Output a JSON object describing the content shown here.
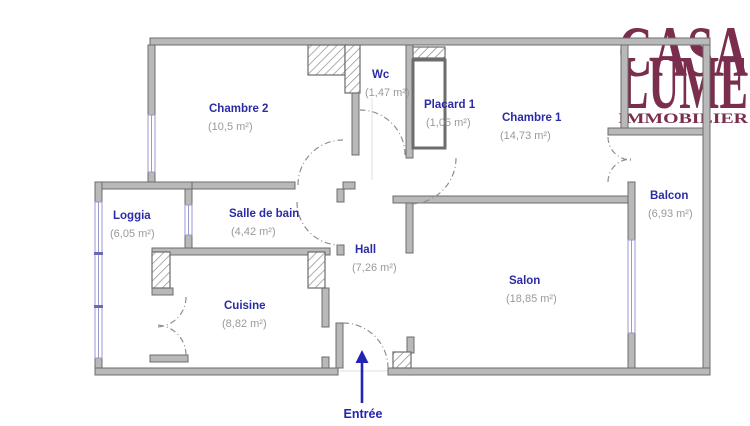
{
  "logo": {
    "title_line1": "CASA",
    "title_line2": "LUME",
    "subtitle": "IMMOBILIER",
    "color": "#7b2d4d"
  },
  "colors": {
    "room_name_blue": "#2b2ba6",
    "room_area_gray": "#9a9a9a",
    "wall_fill": "#b9b9b9",
    "wall_stroke": "#6c6c6c",
    "window_blue": "#9a9ad0",
    "door_arc_gray": "#8f8f8f",
    "entrance_arrow_blue": "#2323b4",
    "logo_maroon": "#7b2d4d"
  },
  "rooms": {
    "chambre2": {
      "name": "Chambre 2",
      "area": "(10,5 m²)"
    },
    "wc": {
      "name": "Wc",
      "area": "(1,47 m²)"
    },
    "placard1": {
      "name": "Placard 1",
      "area": "(1,05 m²)"
    },
    "chambre1": {
      "name": "Chambre 1",
      "area": "(14,73 m²)"
    },
    "balcon": {
      "name": "Balcon",
      "area": "(6,93 m²)"
    },
    "loggia": {
      "name": "Loggia",
      "area": "(6,05 m²)"
    },
    "salle_de_bain": {
      "name": "Salle de bain",
      "area": "(4,42 m²)"
    },
    "hall": {
      "name": "Hall",
      "area": "(7,26 m²)"
    },
    "cuisine": {
      "name": "Cuisine",
      "area": "(8,82 m²)"
    },
    "salon": {
      "name": "Salon",
      "area": "(18,85 m²)"
    }
  },
  "entrance": {
    "label": "Entrée"
  }
}
